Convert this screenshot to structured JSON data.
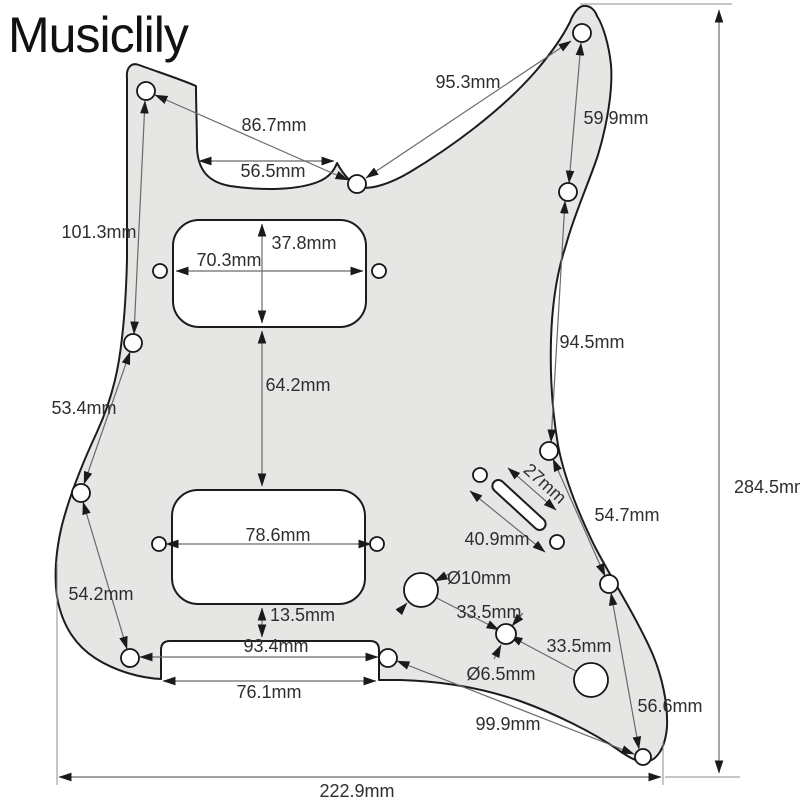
{
  "brand": "Musiclily",
  "dimensions": {
    "horn_diag": "95.3mm",
    "upper_left_diag": "86.7mm",
    "neck_pocket_width": "56.5mm",
    "horn_screw_span": "59.9mm",
    "left_upper_span": "101.3mm",
    "neck_pickup_height": "37.8mm",
    "neck_pickup_width": "70.3mm",
    "right_edge_span": "94.5mm",
    "left_mid_span": "53.4mm",
    "pickup_gap": "64.2mm",
    "switch_slot_length": "27mm",
    "switch_screw_span": "40.9mm",
    "lower_right_span": "54.7mm",
    "bridge_pickup_width": "78.6mm",
    "pot_hole_diameter": "Ø10mm",
    "volume_to_mini": "33.5mm",
    "left_lower_span": "54.2mm",
    "mini_to_tone": "33.5mm",
    "mini_hole_diameter": "Ø6.5mm",
    "bridge_to_notch": "13.5mm",
    "bottom_screw_span": "93.4mm",
    "bottom_notch_width": "76.1mm",
    "bottom_right_span": "56.6mm",
    "bottom_diag": "99.9mm",
    "overall_height": "284.5mm",
    "overall_width": "222.9mm"
  }
}
